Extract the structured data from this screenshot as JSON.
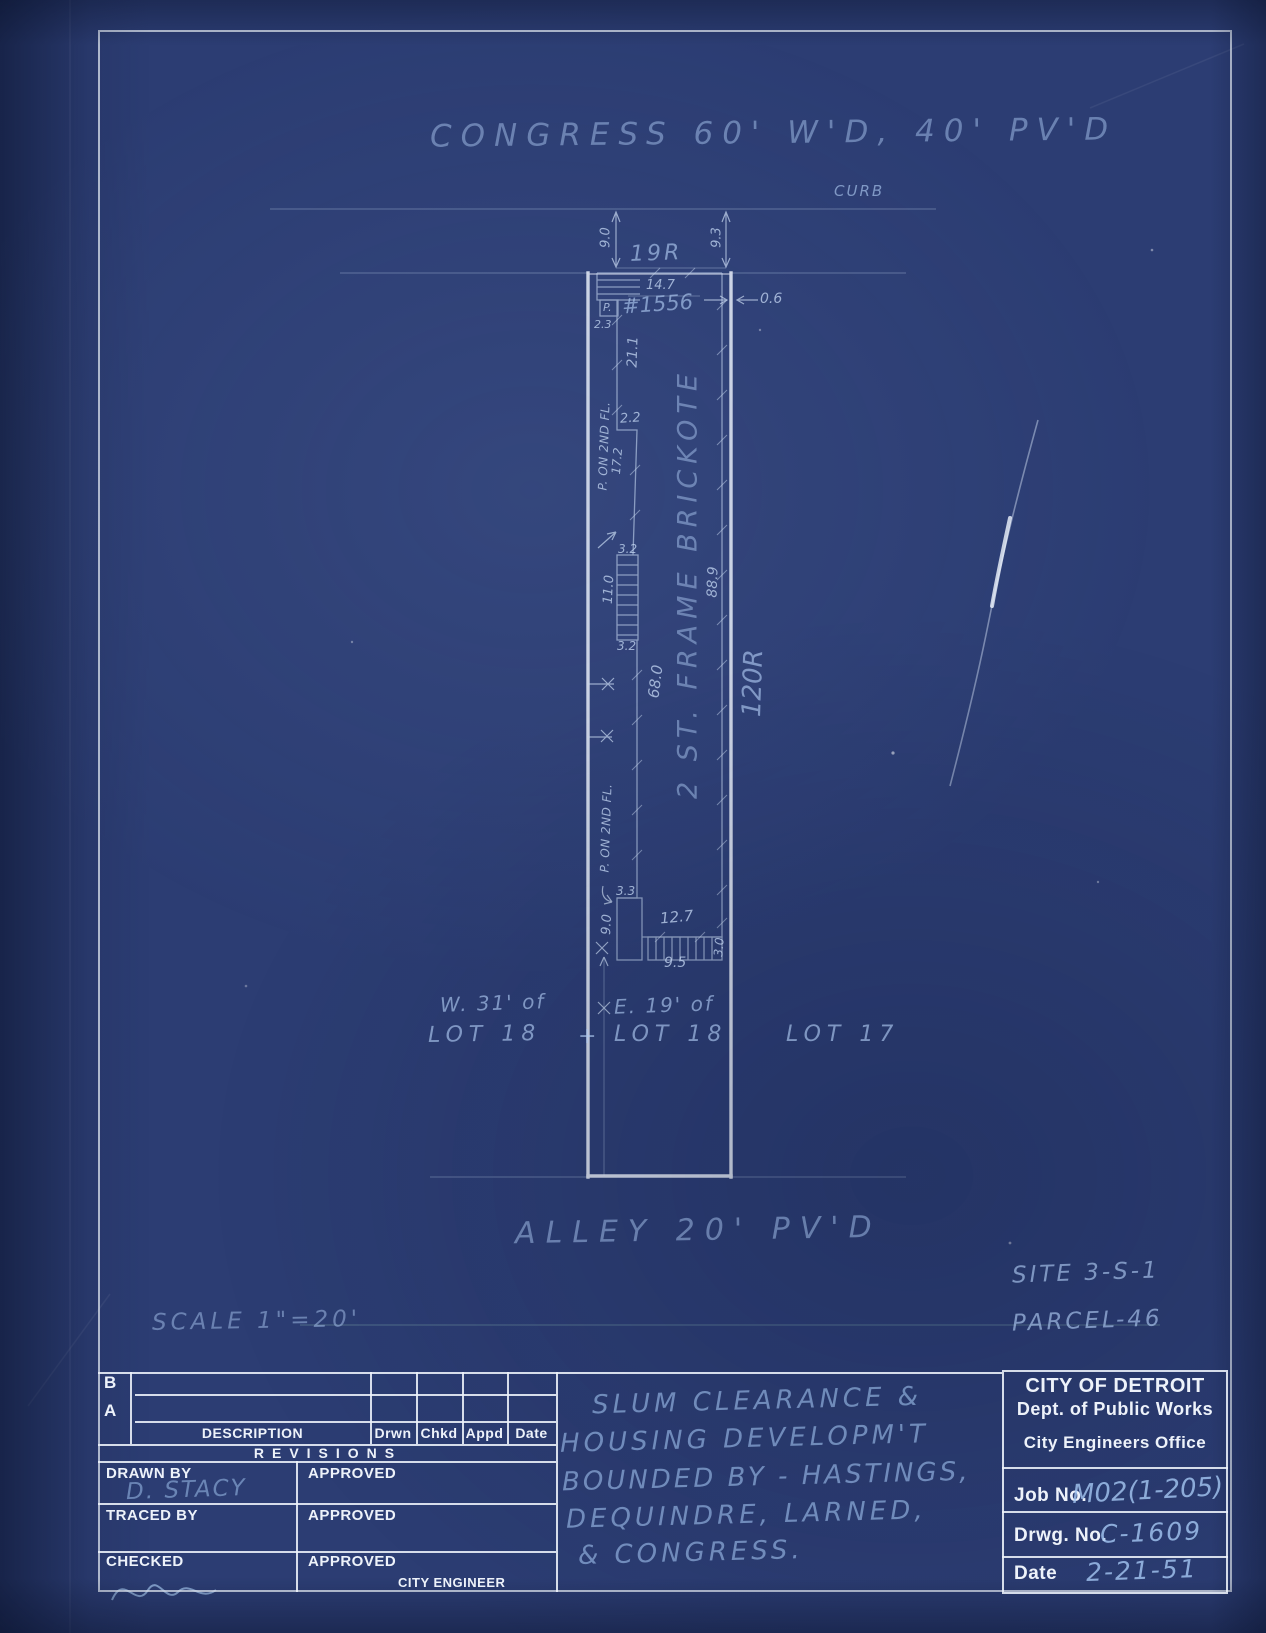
{
  "colors": {
    "paper_blue": "#2c3d73",
    "line_white": "#edf2fa",
    "hand_blue": "#9fc0e8"
  },
  "plan": {
    "street_label": "CONGRESS 60' W'D, 40' PV'D",
    "curb_label": "CURB",
    "alley_label": "ALLEY 20' PV'D",
    "scale_label": "SCALE 1\"=20'",
    "site_label": "SITE 3-S-1",
    "parcel_label": "PARCEL-46",
    "building_label": "2 ST. FRAME BRICKOTE",
    "house_number": "#1556",
    "lots": {
      "west": "W. 31' of",
      "lot18_west": "LOT 18",
      "east": "E. 19' of",
      "lot18_east": "LOT 18",
      "lot17": "LOT 17",
      "tick": "+"
    },
    "dims": {
      "front_setback_left": "9.0",
      "front_setback_right": "9.3",
      "frontage": "19R",
      "building_width": "14.7",
      "side_gap": "0.6",
      "porch": "P.",
      "porch_offset": "2.3",
      "wall_a": "21.1",
      "jog": "2.2",
      "wall_b": "17.2",
      "step_top": "3.2",
      "steps": "11.0",
      "step_bottom": "3.2",
      "wall_c": "68.0",
      "building_depth": "88.9",
      "lot_depth": "120R",
      "porch_note": "P. ON 2ND FL.",
      "rear_porch_width": "3.3",
      "rear_porch_depth": "9.0",
      "rear_width": "12.7",
      "rear_steps_width": "9.5",
      "rear_steps_depth": "3.0"
    }
  },
  "title_block": {
    "revisions": {
      "row_b": "B",
      "row_a": "A",
      "description": "DESCRIPTION",
      "drwn": "Drwn",
      "chkd": "Chkd",
      "appd": "Appd",
      "date": "Date",
      "title": "REVISIONS"
    },
    "signatures": {
      "drawn_by": "DRAWN BY",
      "drawn_by_value": "D. STACY",
      "traced_by": "TRACED BY",
      "checked": "CHECKED",
      "approved": "APPROVED",
      "city_engineer": "CITY ENGINEER"
    },
    "note_lines": [
      "SLUM CLEARANCE &",
      "HOUSING DEVELOPM'T",
      "BOUNDED BY - HASTINGS,",
      "DEQUINDRE, LARNED,",
      "& CONGRESS."
    ],
    "agency": {
      "name": "CITY OF DETROIT",
      "dept": "Dept. of Public Works",
      "office": "City Engineers Office"
    },
    "fields": {
      "job_label": "Job No.",
      "job_value": "M02(1-205)",
      "drwg_label": "Drwg. No.",
      "drwg_value": "C-1609",
      "date_label": "Date",
      "date_value": "2-21-51"
    }
  }
}
